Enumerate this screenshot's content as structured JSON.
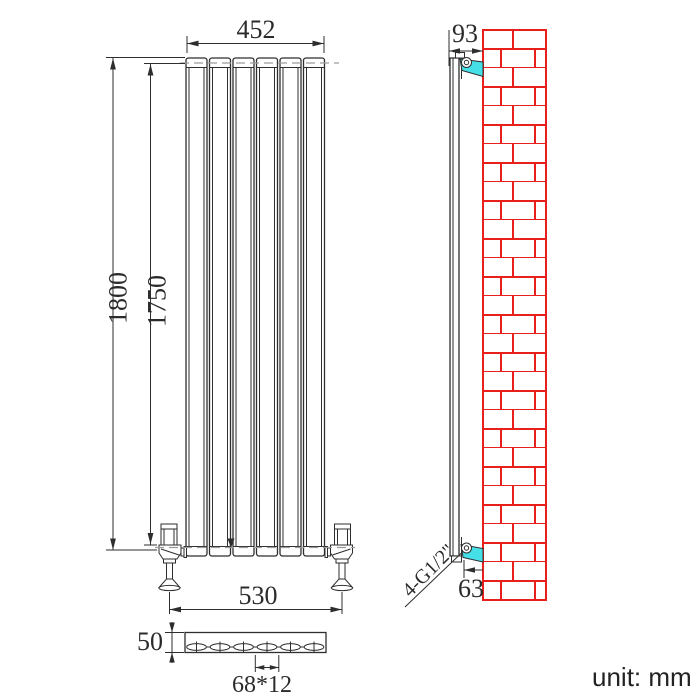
{
  "colors": {
    "brick_red": "#e8201c",
    "bracket_cyan": "#45dfe8",
    "line": "#2e2e2e",
    "centerline": "#9c9c9c"
  },
  "front_view": {
    "width": "452",
    "height": "1800",
    "inner_height": "1750",
    "pipe_spacing": "530"
  },
  "plan_view": {
    "depth": "50",
    "slot_spec": "68*12"
  },
  "side_view": {
    "top_wall_gap": "93",
    "bottom_wall_gap": "63",
    "thread_spec": "4-G1/2\""
  },
  "footer": {
    "unit": "unit: mm"
  }
}
